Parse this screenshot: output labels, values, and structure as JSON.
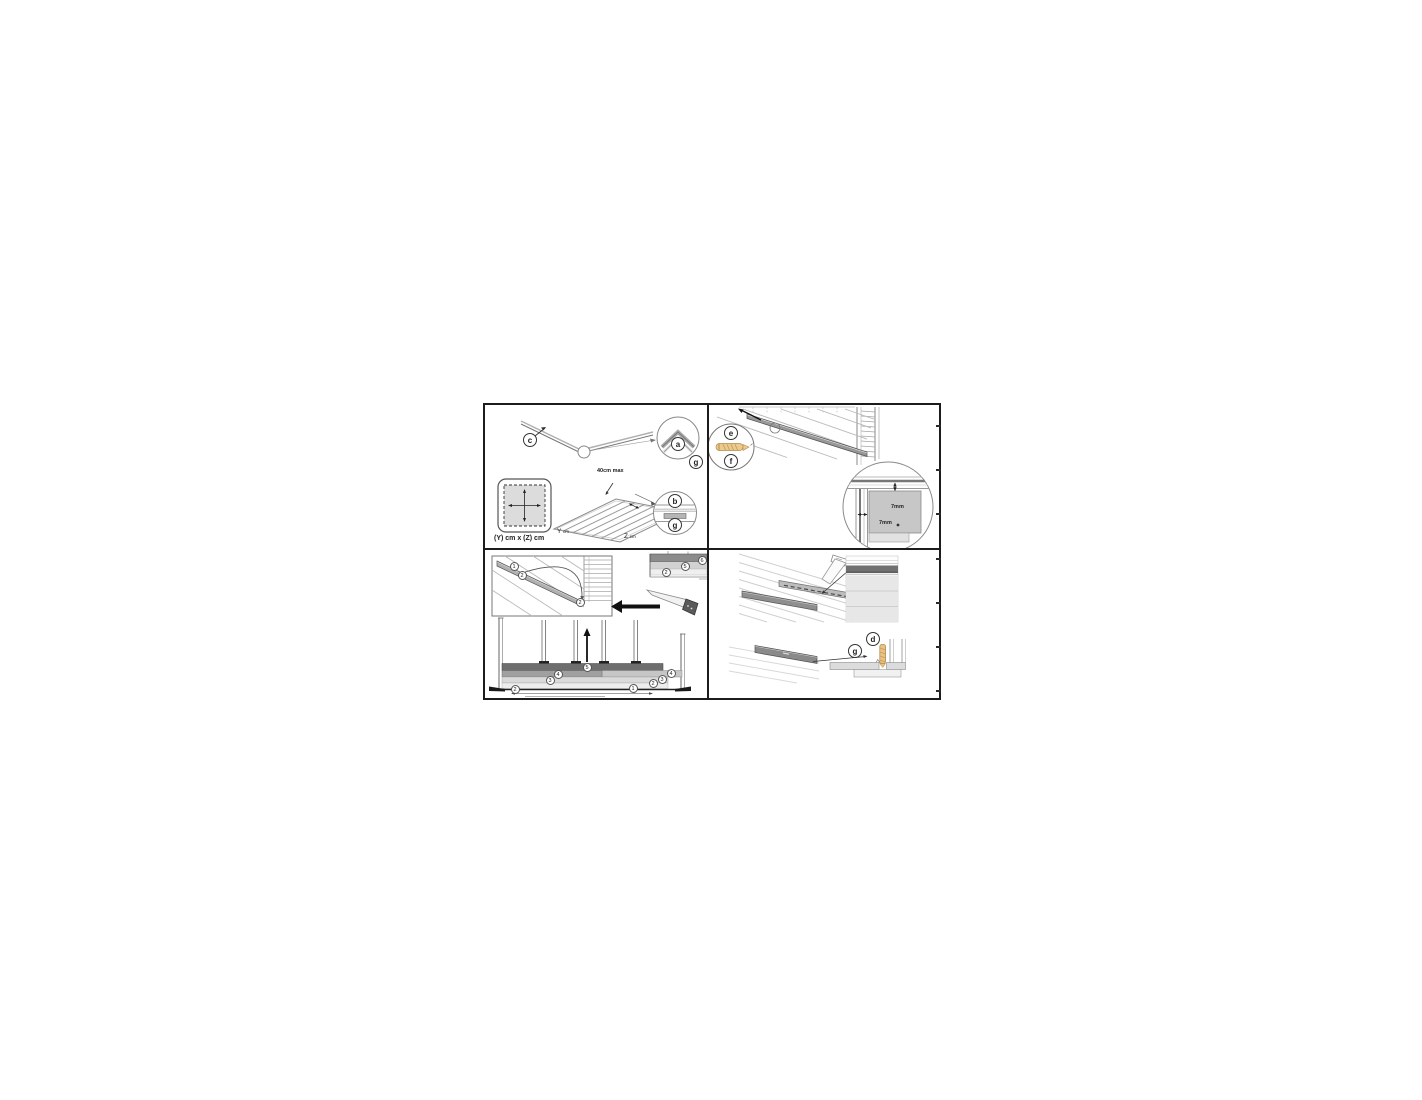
{
  "colors": {
    "panel_border": "#1c1c1c",
    "screw": "#e9c286",
    "board_dark": "#6e6e6e",
    "board_mid": "#a0a0a0",
    "board_light": "#dadada"
  },
  "panel_frame_layout": {
    "callout_c": "c",
    "callout_a": "a",
    "callout_g_corner": "g",
    "callout_b": "b",
    "callout_g_joist": "g",
    "spacing_note": "40cm max",
    "footprint_label": "(Y) cm x (Z) cm",
    "axis_y": "Y",
    "axis_y_unit": "cm",
    "axis_z": "Z",
    "axis_z_unit": "cm"
  },
  "panel_first_board": {
    "callout_e": "e",
    "callout_f": "f",
    "gap_top": "7mm",
    "gap_side": "7mm"
  },
  "panel_floorboards": {
    "iso": {
      "n1": "1",
      "n2": "2",
      "n3": "2"
    },
    "section": {
      "n1": "2",
      "n2": "5",
      "n3": "6"
    },
    "elevation": {
      "l2": "2",
      "l3": "3",
      "l4": "4",
      "c5": "5",
      "r4": "4",
      "r3": "3",
      "r2": "2",
      "r1": "1"
    }
  },
  "panel_threshold": {
    "callout_g": "g",
    "callout_d": "d"
  }
}
